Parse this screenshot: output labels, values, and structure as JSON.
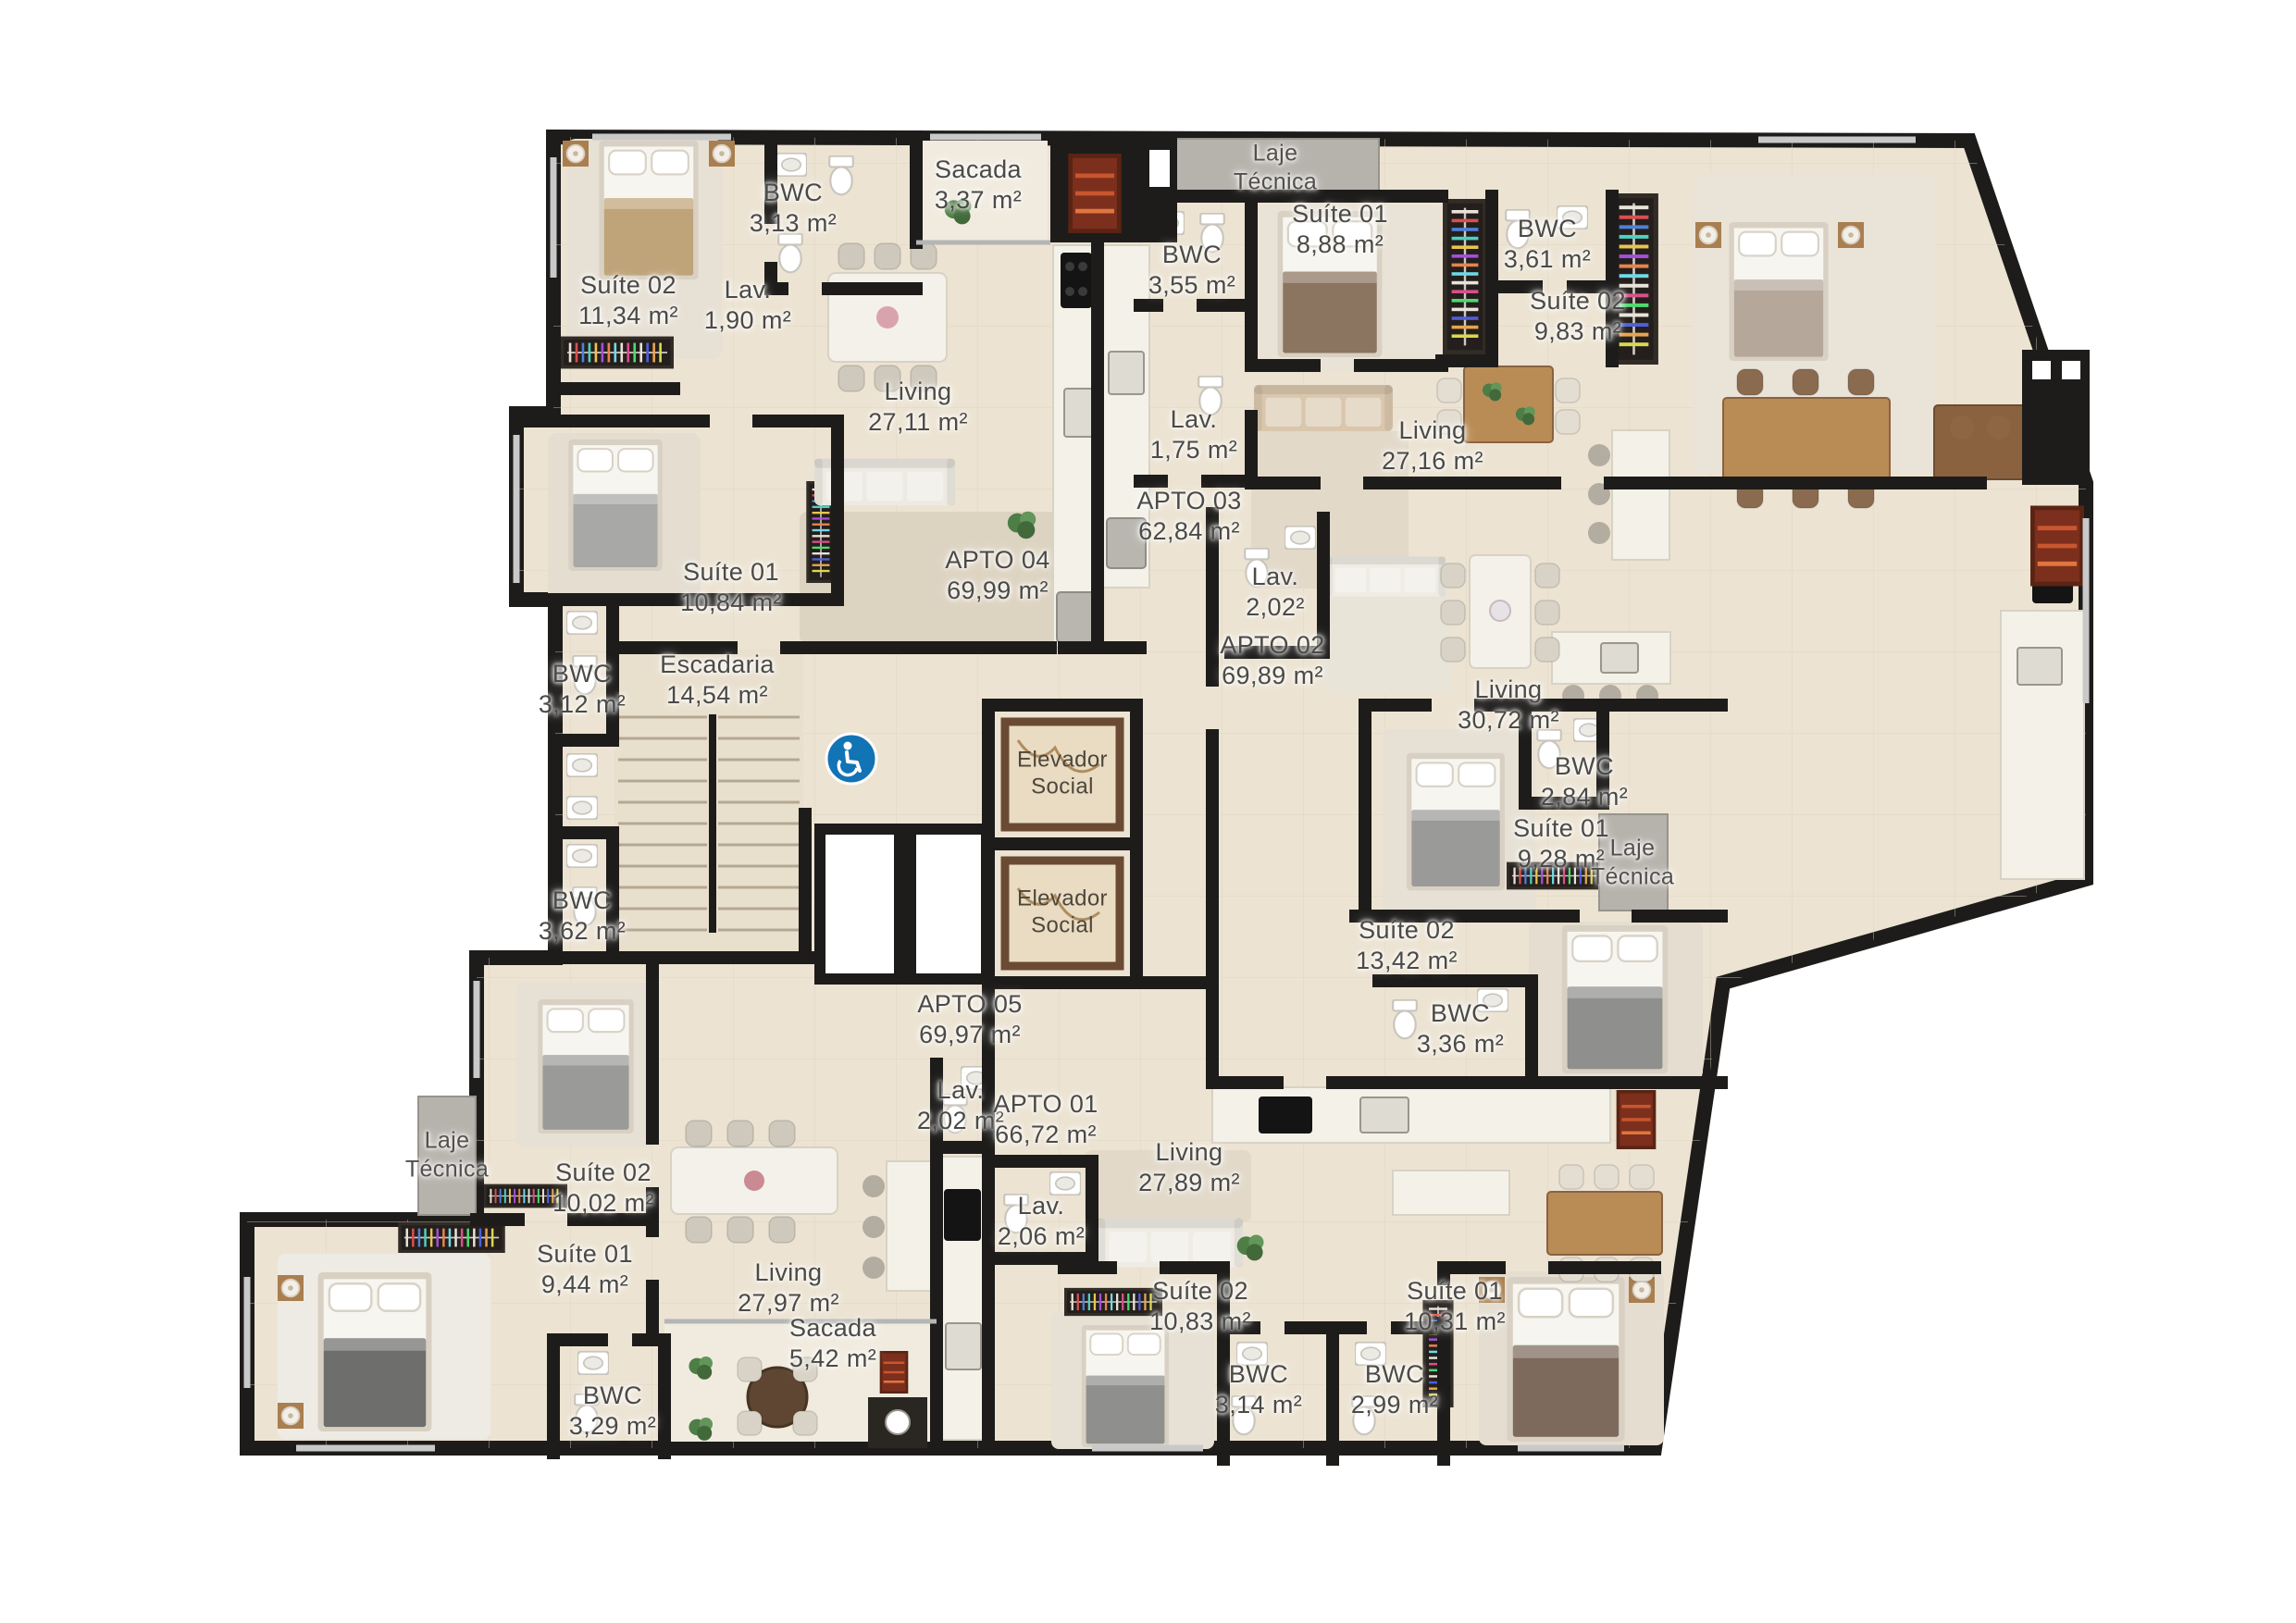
{
  "plan": {
    "type": "residential-floor-plan",
    "colors": {
      "wall": "#1d1c1a",
      "floor": "#ece3d2",
      "laje_gray": "#b6b2ac",
      "accent_blue": "#1273b5",
      "grill_brown": "#7c2f1c"
    },
    "icons": {
      "accessibility": "wheelchair-icon"
    },
    "labels": [
      {
        "name": "Suíte 02",
        "area": "11,34 m²"
      },
      {
        "name": "BWC",
        "area": "3,13 m²"
      },
      {
        "name": "Lav.",
        "area": "1,90 m²"
      },
      {
        "name": "Sacada",
        "area": "3,37 m²"
      },
      {
        "name": "Living",
        "area": "27,11 m²"
      },
      {
        "name": "Suíte 01",
        "area": "10,84 m²"
      },
      {
        "name": "APTO 04",
        "area": "69,99 m²"
      },
      {
        "name": "BWC",
        "area": "3,12 m²"
      },
      {
        "name": "Escadaria",
        "area": "14,54 m²"
      },
      {
        "name": "BWC",
        "area": "3,62 m²"
      },
      {
        "name": "Elevador",
        "area": "Social"
      },
      {
        "name": "Elevador",
        "area": "Social"
      },
      {
        "name": "BWC",
        "area": "3,55 m²"
      },
      {
        "name": "Suíte 01",
        "area": "8,88 m²"
      },
      {
        "name": "Lav.",
        "area": "1,75 m²"
      },
      {
        "name": "APTO 03",
        "area": "62,84 m²"
      },
      {
        "name": "Laje",
        "area": "Técnica"
      },
      {
        "name": "BWC",
        "area": "3,61 m²"
      },
      {
        "name": "Suíte 02",
        "area": "9,83 m²"
      },
      {
        "name": "Living",
        "area": "27,16 m²"
      },
      {
        "name": "APTO 02",
        "area": "69,89 m²"
      },
      {
        "name": "Lav.",
        "area": "2,02²"
      },
      {
        "name": "Living",
        "area": "30,72 m²"
      },
      {
        "name": "BWC",
        "area": "2,84 m²"
      },
      {
        "name": "Suíte 01",
        "area": "9,28 m²"
      },
      {
        "name": "Laje",
        "area": "Técnica"
      },
      {
        "name": "Suíte 02",
        "area": "13,42 m²"
      },
      {
        "name": "BWC",
        "area": "3,36 m²"
      },
      {
        "name": "APTO 05",
        "area": "69,97 m²"
      },
      {
        "name": "Lav.",
        "area": "2,02 m²"
      },
      {
        "name": "APTO 01",
        "area": "66,72 m²"
      },
      {
        "name": "Lav.",
        "area": "2,06 m²"
      },
      {
        "name": "Living",
        "area": "27,89 m²"
      },
      {
        "name": "Suíte 02",
        "area": "10,02 m²"
      },
      {
        "name": "Laje",
        "area": "Técnica"
      },
      {
        "name": "Suíte 01",
        "area": "9,44 m²"
      },
      {
        "name": "Living",
        "area": "27,97 m²"
      },
      {
        "name": "BWC",
        "area": "3,29 m²"
      },
      {
        "name": "Sacada",
        "area": "5,42 m²"
      },
      {
        "name": "Suíte 02",
        "area": "10,83 m²"
      },
      {
        "name": "BWC",
        "area": "3,14 m²"
      },
      {
        "name": "BWC",
        "area": "2,99 m²"
      },
      {
        "name": "Suíte 01",
        "area": "10,31 m²"
      }
    ]
  }
}
